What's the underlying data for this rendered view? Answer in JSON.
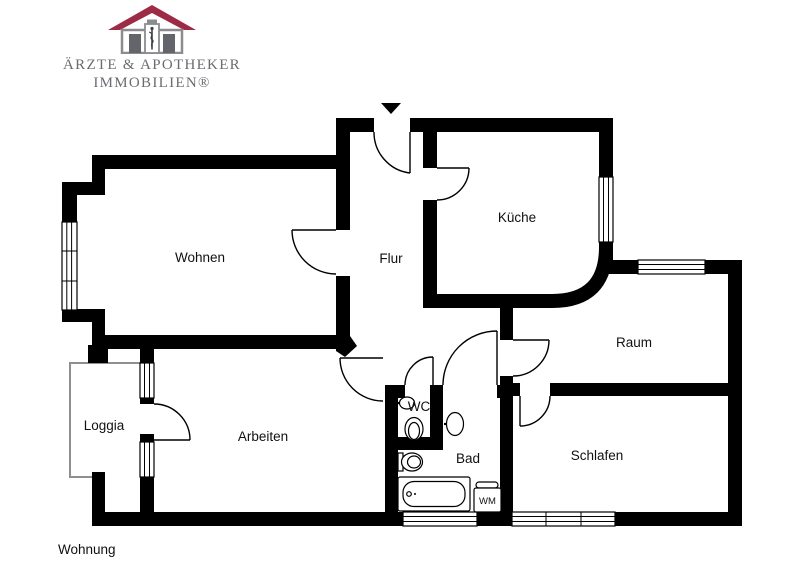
{
  "logo": {
    "line1": "ÄRZTE & APOTHEKER",
    "line2": "IMMOBILIEN®"
  },
  "rooms": {
    "wohnen": "Wohnen",
    "flur": "Flur",
    "kueche": "Küche",
    "raum": "Raum",
    "loggia": "Loggia",
    "arbeiten": "Arbeiten",
    "wc": "WC",
    "bad": "Bad",
    "schlafen": "Schlafen"
  },
  "fixtures": {
    "washing_machine": "WM"
  },
  "caption": "Wohnung",
  "colors": {
    "walls": "#000000",
    "roof": "#9e2b45",
    "logo_text": "#6a6c71",
    "logo_door": "#63656a",
    "logo_outline": "#8a8c90"
  }
}
